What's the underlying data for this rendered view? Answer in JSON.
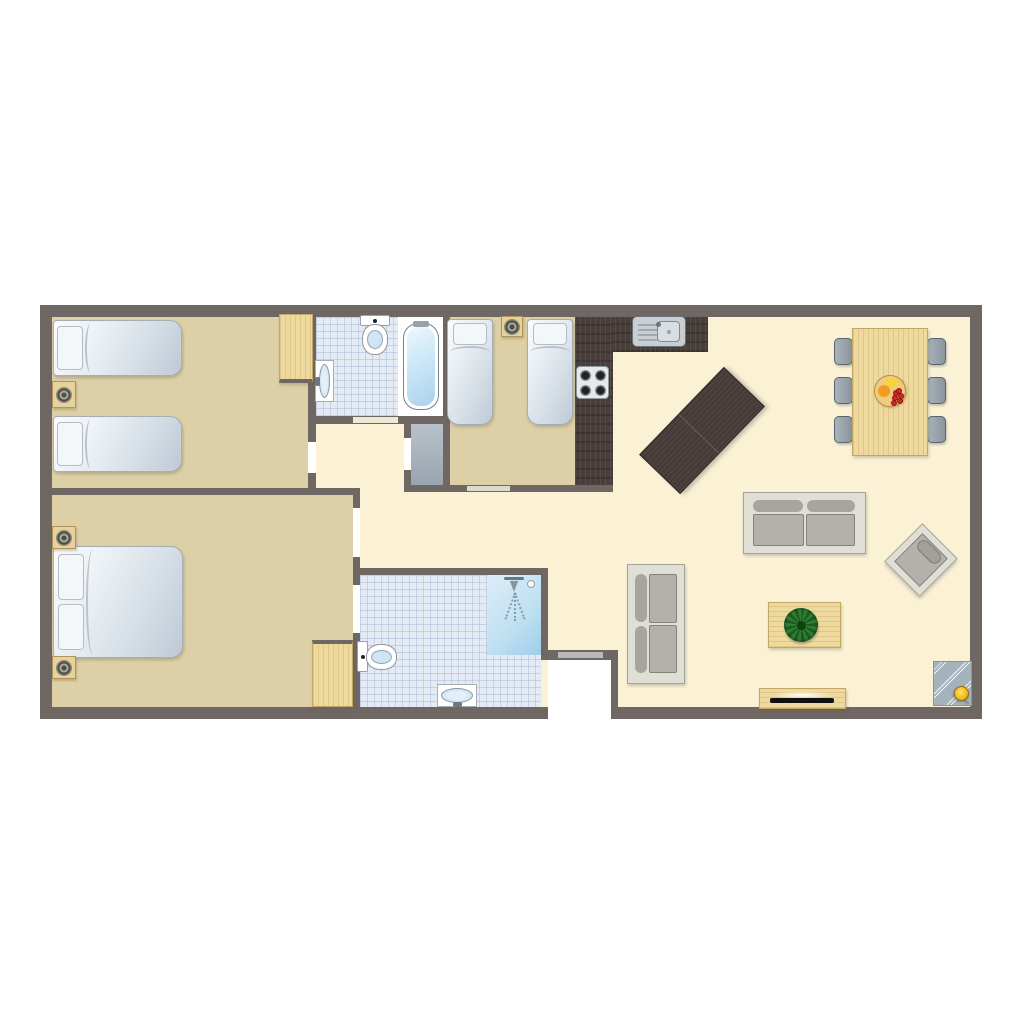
{
  "scene": "apartment-floor-plan",
  "palette": {
    "wall": "#6e6763",
    "cream": "#fbf2d5",
    "tan": "#ddd0a6",
    "white": "#ffffff",
    "threshold_cream": "#efe8d5",
    "threshold_green": "#d9dbcb",
    "front_door": "#bab9b4"
  },
  "canvas": {
    "width": 1024,
    "height": 1024,
    "background": "#ffffff"
  },
  "layers": {
    "floors": [
      {
        "t": "rect",
        "n": "floor-living-area",
        "x": 52,
        "y": 317,
        "w": 918,
        "h": 390,
        "c": "cream"
      },
      {
        "t": "rect",
        "n": "floor-bedroom-twin-left",
        "x": 52,
        "y": 317,
        "w": 258,
        "h": 171,
        "c": "tan"
      },
      {
        "t": "tile",
        "n": "floor-bathroom-top",
        "x": 316,
        "y": 317,
        "w": 134,
        "h": 99
      },
      {
        "t": "rect",
        "n": "floor-bathtub-zone",
        "x": 398,
        "y": 317,
        "w": 45,
        "h": 99,
        "c": "white"
      },
      {
        "t": "rect",
        "n": "floor-bedroom-twin-right",
        "x": 450,
        "y": 317,
        "w": 125,
        "h": 168,
        "c": "tan"
      },
      {
        "t": "rect",
        "n": "floor-bedroom-master",
        "x": 52,
        "y": 495,
        "w": 301,
        "h": 212,
        "c": "tan"
      },
      {
        "t": "tile",
        "n": "floor-bathroom-bottom",
        "x": 360,
        "y": 575,
        "w": 181,
        "h": 132
      },
      {
        "t": "closet",
        "n": "floor-storage-closet",
        "x": 411,
        "y": 424,
        "w": 32,
        "h": 61
      },
      {
        "t": "rect",
        "n": "floor-entrance-alcove",
        "x": 548,
        "y": 660,
        "w": 63,
        "h": 59,
        "c": "white"
      }
    ],
    "counters": [
      {
        "t": "counter",
        "n": "kitchen-counter-top",
        "x": 575,
        "y": 317,
        "w": 133,
        "h": 35
      },
      {
        "t": "counter",
        "n": "kitchen-counter-side",
        "x": 575,
        "y": 317,
        "w": 38,
        "h": 171
      },
      {
        "t": "island",
        "n": "kitchen-island-table",
        "x": 641,
        "y": 402,
        "w": 122,
        "h": 57,
        "r": -46
      }
    ],
    "walls": [
      {
        "t": "wall",
        "n": "wall-outer-top",
        "x": 40,
        "y": 305,
        "w": 942,
        "h": 12
      },
      {
        "t": "wall",
        "n": "wall-outer-left",
        "x": 40,
        "y": 305,
        "w": 12,
        "h": 414
      },
      {
        "t": "wall",
        "n": "wall-outer-right",
        "x": 970,
        "y": 305,
        "w": 12,
        "h": 414
      },
      {
        "t": "wall",
        "n": "wall-outer-bottom-west",
        "x": 40,
        "y": 707,
        "w": 508,
        "h": 12
      },
      {
        "t": "wall",
        "n": "wall-outer-bottom-east",
        "x": 618,
        "y": 707,
        "w": 364,
        "h": 12
      },
      {
        "t": "wall",
        "n": "wall-bedroom1-right",
        "x": 308,
        "y": 317,
        "w": 8,
        "h": 171
      },
      {
        "t": "wall",
        "n": "wall-bathroom-top-south",
        "x": 308,
        "y": 416,
        "w": 142,
        "h": 8
      },
      {
        "t": "wall",
        "n": "wall-bathroom-top-right",
        "x": 443,
        "y": 317,
        "w": 7,
        "h": 168
      },
      {
        "t": "wall",
        "n": "wall-closet-left",
        "x": 404,
        "y": 424,
        "w": 7,
        "h": 61
      },
      {
        "t": "wall",
        "n": "wall-bedroom2-south",
        "x": 404,
        "y": 485,
        "w": 209,
        "h": 7
      },
      {
        "t": "wall",
        "n": "wall-master-north",
        "x": 40,
        "y": 488,
        "w": 320,
        "h": 7
      },
      {
        "t": "wall",
        "n": "wall-master-right",
        "x": 353,
        "y": 495,
        "w": 7,
        "h": 212
      },
      {
        "t": "wall",
        "n": "wall-bathroom-bottom-north",
        "x": 353,
        "y": 568,
        "w": 195,
        "h": 7
      },
      {
        "t": "wall",
        "n": "wall-bathroom-bottom-right",
        "x": 541,
        "y": 575,
        "w": 7,
        "h": 85
      },
      {
        "t": "wall",
        "n": "wall-alcove-north",
        "x": 541,
        "y": 650,
        "w": 77,
        "h": 10
      },
      {
        "t": "wall",
        "n": "wall-alcove-right",
        "x": 611,
        "y": 650,
        "w": 7,
        "h": 69
      }
    ],
    "gaps": [
      {
        "t": "gap",
        "n": "door-opening-bedroom1",
        "x": 308,
        "y": 442,
        "w": 8,
        "h": 31,
        "c": "white"
      },
      {
        "t": "gap",
        "n": "door-opening-bathroom-top",
        "x": 353,
        "y": 417,
        "w": 45,
        "h": 6,
        "c": "threshold_cream"
      },
      {
        "t": "gap",
        "n": "door-opening-closet",
        "x": 404,
        "y": 438,
        "w": 7,
        "h": 32,
        "c": "white"
      },
      {
        "t": "gap",
        "n": "door-opening-bedroom2",
        "x": 467,
        "y": 486,
        "w": 43,
        "h": 5,
        "c": "threshold_green"
      },
      {
        "t": "gap",
        "n": "door-opening-master",
        "x": 353,
        "y": 508,
        "w": 7,
        "h": 49,
        "c": "white"
      },
      {
        "t": "gap",
        "n": "door-opening-ensuite",
        "x": 353,
        "y": 585,
        "w": 7,
        "h": 48,
        "c": "white"
      },
      {
        "t": "gap",
        "n": "front-door",
        "x": 558,
        "y": 652,
        "w": 45,
        "h": 6,
        "c": "front_door"
      }
    ],
    "furniture": [
      {
        "t": "ksink",
        "n": "kitchen-sink",
        "x": 632,
        "y": 316,
        "w": 54,
        "h": 31
      },
      {
        "t": "stove",
        "n": "stove-cooktop",
        "x": 576,
        "y": 366,
        "w": 33,
        "h": 33
      },
      {
        "t": "chair",
        "n": "dining-chair",
        "x": 834,
        "y": 338,
        "w": 19,
        "h": 27
      },
      {
        "t": "chair",
        "n": "dining-chair",
        "x": 834,
        "y": 377,
        "w": 19,
        "h": 27
      },
      {
        "t": "chair",
        "n": "dining-chair",
        "x": 834,
        "y": 416,
        "w": 19,
        "h": 27
      },
      {
        "t": "chair",
        "n": "dining-chair",
        "x": 927,
        "y": 338,
        "w": 19,
        "h": 27
      },
      {
        "t": "chair",
        "n": "dining-chair",
        "x": 927,
        "y": 377,
        "w": 19,
        "h": 27
      },
      {
        "t": "chair",
        "n": "dining-chair",
        "x": 927,
        "y": 416,
        "w": 19,
        "h": 27
      },
      {
        "t": "wood",
        "n": "dining-table",
        "x": 852,
        "y": 328,
        "w": 76,
        "h": 128,
        "g": "gv"
      },
      {
        "t": "bowl",
        "n": "fruit-bowl",
        "x": 874,
        "y": 375,
        "w": 32,
        "h": 32
      },
      {
        "t": "sofah",
        "n": "sofa-two-seater",
        "x": 743,
        "y": 492,
        "w": 123,
        "h": 62
      },
      {
        "t": "sofav",
        "n": "sofa-two-seater",
        "x": 627,
        "y": 564,
        "w": 58,
        "h": 120
      },
      {
        "t": "armchair",
        "n": "armchair",
        "x": 896,
        "y": 533,
        "w": 50,
        "h": 54,
        "r": 45
      },
      {
        "t": "wood",
        "n": "coffee-table",
        "x": 768,
        "y": 602,
        "w": 73,
        "h": 46,
        "g": "gh"
      },
      {
        "t": "plant",
        "n": "potted-plant",
        "x": 784,
        "y": 608,
        "w": 34,
        "h": 34
      },
      {
        "t": "wood",
        "n": "tv-stand",
        "x": 759,
        "y": 688,
        "w": 87,
        "h": 21,
        "g": "gh"
      },
      {
        "t": "tv",
        "n": "television",
        "x": 770,
        "y": 691,
        "w": 64,
        "h": 12
      },
      {
        "t": "mat",
        "n": "entrance-mat",
        "x": 933,
        "y": 661,
        "w": 39,
        "h": 45
      },
      {
        "t": "bedh",
        "n": "single-bed",
        "x": 53,
        "y": 320,
        "w": 129,
        "h": 56
      },
      {
        "t": "bedh",
        "n": "single-bed",
        "x": 53,
        "y": 416,
        "w": 129,
        "h": 56
      },
      {
        "t": "nstand",
        "n": "nightstand",
        "x": 52,
        "y": 381,
        "w": 24,
        "h": 27
      },
      {
        "t": "wardrobe",
        "n": "wardrobe",
        "x": 279,
        "y": 314,
        "w": 34,
        "h": 69,
        "e": "edge-b"
      },
      {
        "t": "bedv",
        "n": "single-bed",
        "x": 447,
        "y": 319,
        "w": 46,
        "h": 106
      },
      {
        "t": "bedv",
        "n": "single-bed",
        "x": 527,
        "y": 319,
        "w": 46,
        "h": 106
      },
      {
        "t": "nstand",
        "n": "nightstand",
        "x": 501,
        "y": 316,
        "w": 22,
        "h": 21
      },
      {
        "t": "beddbl",
        "n": "double-bed",
        "x": 53,
        "y": 546,
        "w": 130,
        "h": 112
      },
      {
        "t": "nstand",
        "n": "nightstand",
        "x": 52,
        "y": 526,
        "w": 24,
        "h": 23
      },
      {
        "t": "nstand",
        "n": "nightstand",
        "x": 52,
        "y": 656,
        "w": 24,
        "h": 23
      },
      {
        "t": "wardrobe",
        "n": "wardrobe",
        "x": 312,
        "y": 640,
        "w": 41,
        "h": 67,
        "e": "edge-t"
      },
      {
        "t": "toilet",
        "n": "toilet",
        "x": 360,
        "y": 315,
        "w": 30,
        "h": 42,
        "dir": "down"
      },
      {
        "t": "bsink",
        "n": "washbasin",
        "x": 315,
        "y": 360,
        "w": 19,
        "h": 42,
        "tap": "left"
      },
      {
        "t": "tub",
        "n": "bathtub",
        "x": 403,
        "y": 323,
        "w": 36,
        "h": 87
      },
      {
        "t": "shower",
        "n": "shower",
        "x": 487,
        "y": 575,
        "w": 54,
        "h": 80
      },
      {
        "t": "toilet",
        "n": "toilet",
        "x": 357,
        "y": 641,
        "w": 42,
        "h": 31,
        "dir": "right"
      },
      {
        "t": "bsink",
        "n": "washbasin",
        "x": 437,
        "y": 684,
        "w": 40,
        "h": 23,
        "tap": "bottom"
      }
    ]
  }
}
